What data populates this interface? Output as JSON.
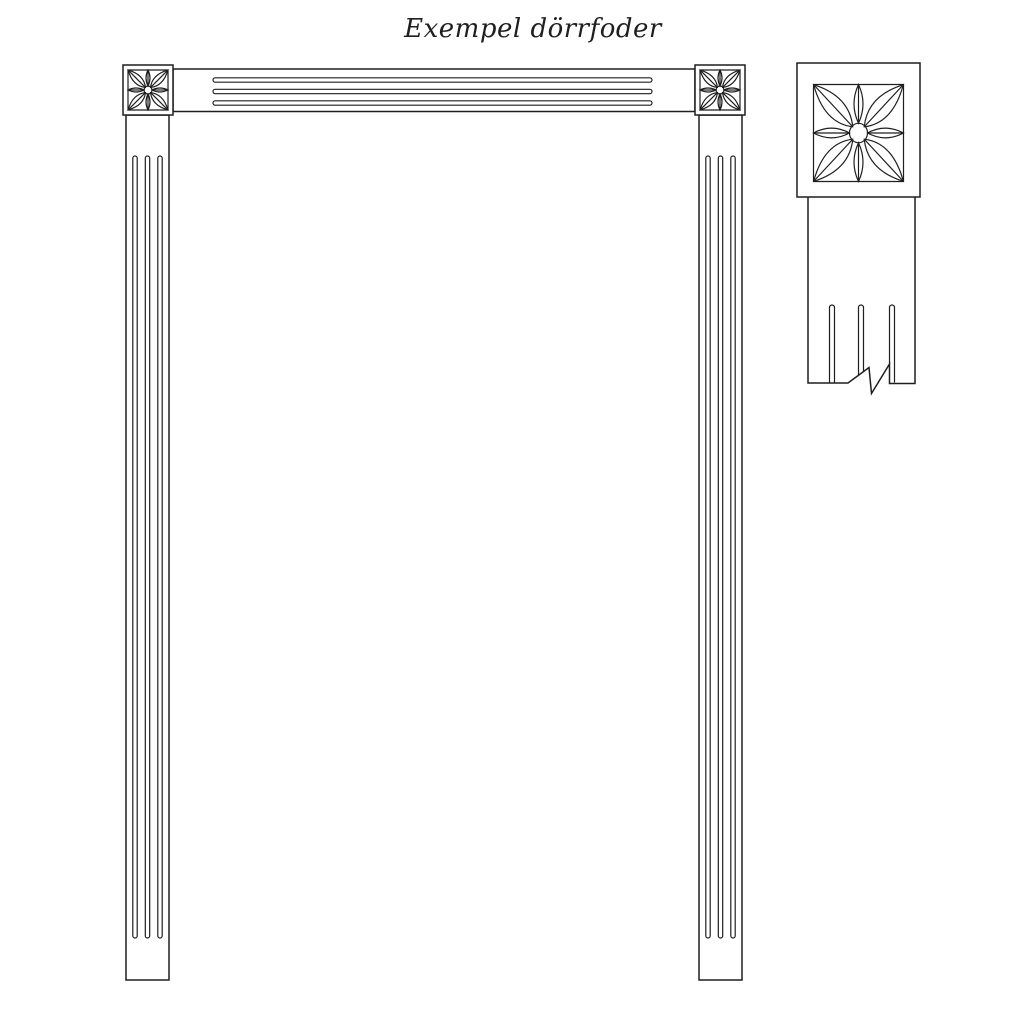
{
  "title": "Exempel dörrfoder",
  "colors": {
    "background": "#ffffff",
    "line": "#1f1f1f"
  },
  "icons": {
    "corner_block": "eight-petal-rosette-icon"
  }
}
